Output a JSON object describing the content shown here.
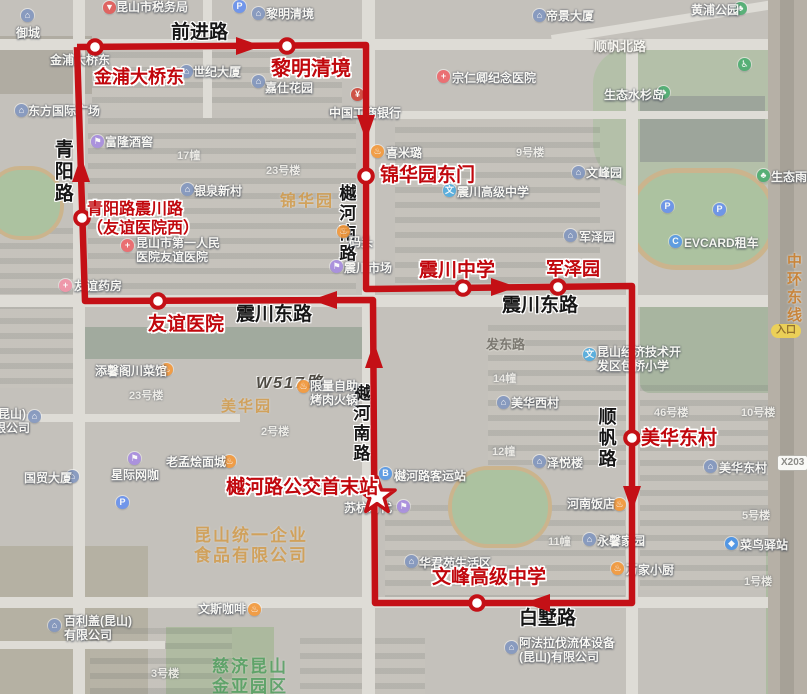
{
  "map": {
    "route": {
      "color": "#c41016",
      "path": "77,47 366,45 366,289 632,286 632,603 375,603 373,300 85,301 77,47",
      "arrows": [
        {
          "x": 248,
          "y": 46,
          "d": "right"
        },
        {
          "x": 366,
          "y": 127,
          "d": "down"
        },
        {
          "x": 503,
          "y": 287,
          "d": "right"
        },
        {
          "x": 632,
          "y": 498,
          "d": "down"
        },
        {
          "x": 538,
          "y": 603,
          "d": "left"
        },
        {
          "x": 374,
          "y": 356,
          "d": "up"
        },
        {
          "x": 81,
          "y": 170,
          "d": "up"
        },
        {
          "x": 325,
          "y": 300,
          "d": "left"
        }
      ],
      "stops": [
        {
          "t": "金浦大桥东",
          "x": 95,
          "y": 47,
          "lx": 94,
          "ly": 67,
          "s": 18
        },
        {
          "t": "黎明清境",
          "x": 287,
          "y": 46,
          "lx": 271,
          "ly": 58,
          "s": 20
        },
        {
          "t": "锦华园东门",
          "x": 366,
          "y": 176,
          "lx": 380,
          "ly": 165,
          "s": 19
        },
        {
          "t": "震川中学",
          "x": 463,
          "y": 288,
          "lx": 419,
          "ly": 260,
          "s": 19
        },
        {
          "t": "军泽园",
          "x": 558,
          "y": 287,
          "lx": 546,
          "ly": 259,
          "s": 18
        },
        {
          "t": "美华东村",
          "x": 632,
          "y": 438,
          "lx": 641,
          "ly": 428,
          "s": 19
        },
        {
          "t": "文峰高级中学",
          "x": 477,
          "y": 603,
          "lx": 432,
          "ly": 567,
          "s": 19
        },
        {
          "t": "友谊医院",
          "x": 158,
          "y": 301,
          "lx": 148,
          "ly": 314,
          "s": 19
        },
        {
          "lines": [
            "青阳路震川路",
            "（友谊医院西）"
          ],
          "x": 82,
          "y": 218,
          "lx": 87,
          "ly": 201,
          "s": 16
        }
      ],
      "terminal": {
        "t": "樾河路公交首末站",
        "x": 377,
        "y": 496,
        "lx": 226,
        "ly": 477,
        "s": 19
      }
    },
    "road_labels": [
      {
        "t": "前进路",
        "x": 171,
        "y": 22,
        "s": 19,
        "k": "major"
      },
      {
        "t": "青阳路",
        "x": 50,
        "y": 139,
        "s": 19,
        "k": "major",
        "v": true
      },
      {
        "t": "樾河南路",
        "x": 335,
        "y": 184,
        "s": 17,
        "k": "major",
        "v": true
      },
      {
        "t": "樾河南路",
        "x": 349,
        "y": 384,
        "s": 17,
        "k": "major",
        "v": true
      },
      {
        "t": "震川东路",
        "x": 236,
        "y": 304,
        "s": 19,
        "k": "major"
      },
      {
        "t": "震川东路",
        "x": 502,
        "y": 295,
        "s": 19,
        "k": "major"
      },
      {
        "t": "顺帆路",
        "x": 595,
        "y": 407,
        "s": 18,
        "k": "major",
        "v": true
      },
      {
        "t": "白墅路",
        "x": 519,
        "y": 608,
        "s": 19,
        "k": "major"
      },
      {
        "t": "顺帆北路",
        "x": 594,
        "y": 39,
        "s": 13,
        "k": "white"
      },
      {
        "t": "发东路",
        "x": 486,
        "y": 337,
        "s": 13,
        "k": "gray"
      },
      {
        "t": "W517路",
        "x": 256,
        "y": 374,
        "s": 16,
        "k": "italic"
      },
      {
        "t": "中环东线",
        "x": 784,
        "y": 253,
        "s": 15,
        "k": "orange",
        "v": true
      }
    ],
    "poi_labels": [
      {
        "t": "昆山市税务局",
        "x": 116,
        "y": 0,
        "icon": {
          "type": "pin",
          "x": 103,
          "y": 1
        }
      },
      {
        "t": "御城",
        "x": 16,
        "y": 26,
        "icon": {
          "type": "building",
          "x": 21,
          "y": 9
        }
      },
      {
        "t": "黎明清境",
        "x": 266,
        "y": 7,
        "icon": {
          "type": "building",
          "x": 252,
          "y": 7
        }
      },
      {
        "t": "帝景大厦",
        "x": 546,
        "y": 9,
        "icon": {
          "type": "building",
          "x": 533,
          "y": 9
        }
      },
      {
        "t": "金浦大桥东",
        "x": 50,
        "y": 53
      },
      {
        "t": "世纪大厦",
        "x": 193,
        "y": 65,
        "icon": {
          "type": "building",
          "x": 180,
          "y": 65
        }
      },
      {
        "t": "嘉仕花园",
        "x": 265,
        "y": 81,
        "icon": {
          "type": "building",
          "x": 252,
          "y": 75
        }
      },
      {
        "t": "宗仁卿纪念医院",
        "x": 452,
        "y": 71,
        "icon": {
          "type": "hospital",
          "x": 437,
          "y": 70
        }
      },
      {
        "t": "中国工商银行",
        "x": 329,
        "y": 106,
        "icon": {
          "type": "bank",
          "x": 351,
          "y": 88
        }
      },
      {
        "t": "东方国际广场",
        "x": 28,
        "y": 104,
        "icon": {
          "type": "building",
          "x": 15,
          "y": 104
        }
      },
      {
        "t": "富隆酒窖",
        "x": 105,
        "y": 135,
        "icon": {
          "type": "shop",
          "x": 91,
          "y": 135
        }
      },
      {
        "t": "银泉新村",
        "x": 194,
        "y": 184,
        "icon": {
          "type": "building",
          "x": 181,
          "y": 183
        }
      },
      {
        "lines": [
          "昆山市第一人民",
          "医院友谊医院"
        ],
        "x": 136,
        "y": 236,
        "icon": {
          "type": "hospital",
          "x": 121,
          "y": 239
        }
      },
      {
        "t": "友谊药房",
        "x": 74,
        "y": 279,
        "icon": {
          "type": "pharmacy",
          "x": 59,
          "y": 279
        }
      },
      {
        "t": "喜米璐",
        "x": 386,
        "y": 146,
        "icon": {
          "type": "food",
          "x": 371,
          "y": 145
        }
      },
      {
        "t": "震川高级中学",
        "x": 457,
        "y": 185,
        "icon": {
          "type": "school",
          "x": 443,
          "y": 184
        }
      },
      {
        "t": "震川市场",
        "x": 344,
        "y": 261,
        "icon": {
          "type": "shop",
          "x": 330,
          "y": 260
        }
      },
      {
        "t": "码头",
        "x": 349,
        "y": 235,
        "icon": {
          "type": "food",
          "x": 337,
          "y": 225
        }
      },
      {
        "t": "军泽园",
        "x": 579,
        "y": 230,
        "icon": {
          "type": "building",
          "x": 564,
          "y": 229
        }
      },
      {
        "t": "文峰园",
        "x": 586,
        "y": 166,
        "icon": {
          "type": "building",
          "x": 572,
          "y": 166
        }
      },
      {
        "t": "EVCARD租车",
        "x": 684,
        "y": 236,
        "icon": {
          "type": "car",
          "x": 669,
          "y": 235
        }
      },
      {
        "icon": {
          "type": "parking",
          "x": 661,
          "y": 200
        }
      },
      {
        "icon": {
          "type": "parking",
          "x": 713,
          "y": 203
        }
      },
      {
        "icon": {
          "type": "parking",
          "x": 233,
          "y": 0
        }
      },
      {
        "icon": {
          "type": "parking",
          "x": 116,
          "y": 496
        }
      },
      {
        "t": "黄浦公园",
        "x": 691,
        "y": 3,
        "icon": {
          "type": "park",
          "x": 734,
          "y": 2
        }
      },
      {
        "t": "生态水杉岛",
        "x": 604,
        "y": 88,
        "icon": {
          "type": "park",
          "x": 657,
          "y": 86
        }
      },
      {
        "icon": {
          "type": "toilet",
          "x": 738,
          "y": 58
        }
      },
      {
        "t": "生态雨林",
        "x": 771,
        "y": 170,
        "icon": {
          "type": "park",
          "x": 757,
          "y": 169
        }
      },
      {
        "t": "美华西村",
        "x": 511,
        "y": 396,
        "icon": {
          "type": "building",
          "x": 497,
          "y": 396
        }
      },
      {
        "t": "美华东村",
        "x": 719,
        "y": 461,
        "icon": {
          "type": "building",
          "x": 704,
          "y": 460
        }
      },
      {
        "t": "泽悦楼",
        "x": 547,
        "y": 456,
        "icon": {
          "type": "building",
          "x": 533,
          "y": 455
        }
      },
      {
        "t": "河南饭店",
        "x": 567,
        "y": 497,
        "icon": {
          "type": "food",
          "x": 613,
          "y": 498
        }
      },
      {
        "t": "永馨家园",
        "x": 597,
        "y": 534,
        "icon": {
          "type": "building",
          "x": 583,
          "y": 533
        }
      },
      {
        "t": "万家小厨",
        "x": 626,
        "y": 563,
        "icon": {
          "type": "food",
          "x": 611,
          "y": 562
        }
      },
      {
        "t": "菜鸟驿站",
        "x": 740,
        "y": 538,
        "icon": {
          "type": "delivery",
          "x": 725,
          "y": 537
        }
      },
      {
        "t": "华君苑生活区",
        "x": 419,
        "y": 556,
        "icon": {
          "type": "building",
          "x": 405,
          "y": 555
        }
      },
      {
        "t": "樾河路客运站",
        "x": 394,
        "y": 469,
        "icon": {
          "type": "bus",
          "x": 379,
          "y": 467
        }
      },
      {
        "t": "苏杭时代",
        "x": 344,
        "y": 501,
        "icon": {
          "type": "shop",
          "x": 397,
          "y": 500
        }
      },
      {
        "t": "添馨阁川菜馆",
        "x": 95,
        "y": 364,
        "icon": {
          "type": "food",
          "x": 160,
          "y": 363
        }
      },
      {
        "lines": [
          "限量自助",
          "烤肉火锅"
        ],
        "x": 310,
        "y": 379,
        "icon": {
          "type": "food",
          "x": 297,
          "y": 380
        }
      },
      {
        "t": "国贸大厦",
        "x": 24,
        "y": 471,
        "icon": {
          "type": "building",
          "x": 66,
          "y": 470
        }
      },
      {
        "t": "星际网咖",
        "x": 111,
        "y": 468,
        "icon": {
          "type": "shop",
          "x": 128,
          "y": 452
        }
      },
      {
        "t": "老孟烩面城",
        "x": 166,
        "y": 455,
        "icon": {
          "type": "food",
          "x": 223,
          "y": 455
        }
      },
      {
        "lines": [
          "百利盖(昆山)",
          "有限公司"
        ],
        "x": 64,
        "y": 614,
        "icon": {
          "type": "building",
          "x": 48,
          "y": 619
        }
      },
      {
        "t": "文斯咖啡",
        "x": 198,
        "y": 602,
        "icon": {
          "type": "coffee",
          "x": 248,
          "y": 603
        }
      },
      {
        "lines": [
          "(昆山)",
          "限公司"
        ],
        "x": -6,
        "y": 407,
        "icon": {
          "type": "building",
          "x": 28,
          "y": 410
        }
      },
      {
        "lines": [
          "阿法拉伐流体设备",
          "(昆山)有限公司"
        ],
        "x": 519,
        "y": 636,
        "icon": {
          "type": "building",
          "x": 505,
          "y": 641
        }
      },
      {
        "lines": [
          "昆山经济技术开",
          "发区包桥小学"
        ],
        "x": 597,
        "y": 345,
        "icon": {
          "type": "school",
          "x": 583,
          "y": 348
        }
      }
    ],
    "building_labels": [
      {
        "t": "17幢",
        "x": 177,
        "y": 150
      },
      {
        "t": "9号楼",
        "x": 516,
        "y": 147
      },
      {
        "t": "23号楼",
        "x": 266,
        "y": 165
      },
      {
        "t": "23号楼",
        "x": 129,
        "y": 390
      },
      {
        "t": "2号楼",
        "x": 261,
        "y": 426
      },
      {
        "t": "46号楼",
        "x": 654,
        "y": 407
      },
      {
        "t": "10号楼",
        "x": 741,
        "y": 407
      },
      {
        "t": "14幢",
        "x": 493,
        "y": 373
      },
      {
        "t": "12幢",
        "x": 492,
        "y": 446
      },
      {
        "t": "5号楼",
        "x": 742,
        "y": 510
      },
      {
        "t": "11幢",
        "x": 548,
        "y": 536
      },
      {
        "t": "1号楼",
        "x": 744,
        "y": 576
      },
      {
        "t": "3号楼",
        "x": 151,
        "y": 668
      }
    ],
    "area_labels": [
      {
        "lines": [
          "锦华园"
        ],
        "x": 280,
        "y": 192,
        "s": 16,
        "color": "#d49a45"
      },
      {
        "lines": [
          "美华园"
        ],
        "x": 221,
        "y": 398,
        "s": 15,
        "color": "#d49a45"
      },
      {
        "lines": [
          "昆山统一企业",
          "食品有限公司"
        ],
        "x": 194,
        "y": 526,
        "s": 17,
        "color": "#d49a45"
      },
      {
        "lines": [
          "慈济昆山",
          "金亚园区"
        ],
        "x": 212,
        "y": 657,
        "s": 17,
        "color": "#4d9e5d"
      }
    ],
    "badges": [
      {
        "t": "入口",
        "x": 771,
        "y": 324,
        "kind": "entrance"
      },
      {
        "t": "X203",
        "x": 777,
        "y": 455,
        "kind": "code"
      }
    ],
    "icon_colors": {
      "building": "#8498c0",
      "hospital": "#ee6a6d",
      "pharmacy": "#f295a9",
      "school": "#54aee0",
      "bank": "#cf4a3e",
      "food": "#f49a3e",
      "coffee": "#f49a3e",
      "shop": "#a98fe0",
      "park": "#4fae72",
      "parking": "#6a93ee",
      "bus": "#5a9ae6",
      "car": "#5a9ae6",
      "delivery": "#4a94e8",
      "toilet": "#4fae72",
      "pin": "#e25d5a"
    },
    "icon_glyphs": {
      "building": "⌂",
      "hospital": "+",
      "pharmacy": "+",
      "school": "文",
      "bank": "¥",
      "food": "♨",
      "coffee": "♨",
      "shop": "⚑",
      "park": "♣",
      "parking": "P",
      "bus": "B",
      "car": "C",
      "delivery": "◆",
      "toilet": "♿",
      "pin": "▼"
    }
  }
}
